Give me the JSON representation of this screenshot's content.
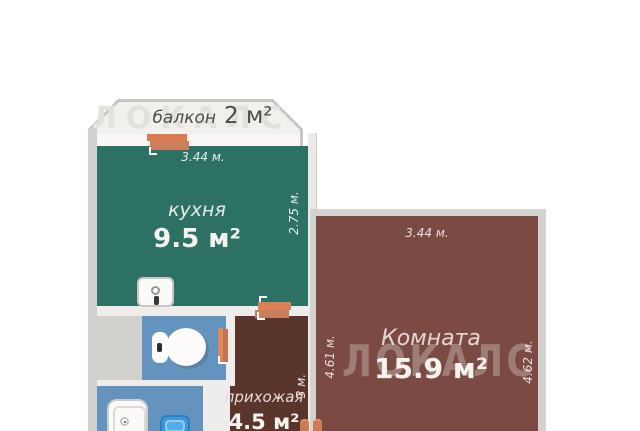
{
  "watermark": {
    "text": "ЛОКАЛС"
  },
  "balcony": {
    "name": "балкон",
    "area": "2 м²"
  },
  "kitchen": {
    "name": "кухня",
    "area": "9.5 м²",
    "dim_top": "3.44 м.",
    "dim_right": "2.75 м."
  },
  "room": {
    "name": "Комната",
    "area": "15.9 м²",
    "dim_top": "3.44 м.",
    "dim_left": "4.61 м.",
    "dim_right": "4.62 м."
  },
  "hallway": {
    "name": "прихожая",
    "area": "4.5 м²",
    "dim_right": "3 м."
  },
  "colors": {
    "kitchen_floor": "#2d7164",
    "room_floor": "#7b4b43",
    "hallway_floor": "#5a352c",
    "wet_room_floor": "#6494be",
    "wall": "#d3d1ce",
    "balcony_fill": "#f2f0ed",
    "door_accent": "#dc7b4f",
    "washbasin_blue": "#3e97da"
  }
}
